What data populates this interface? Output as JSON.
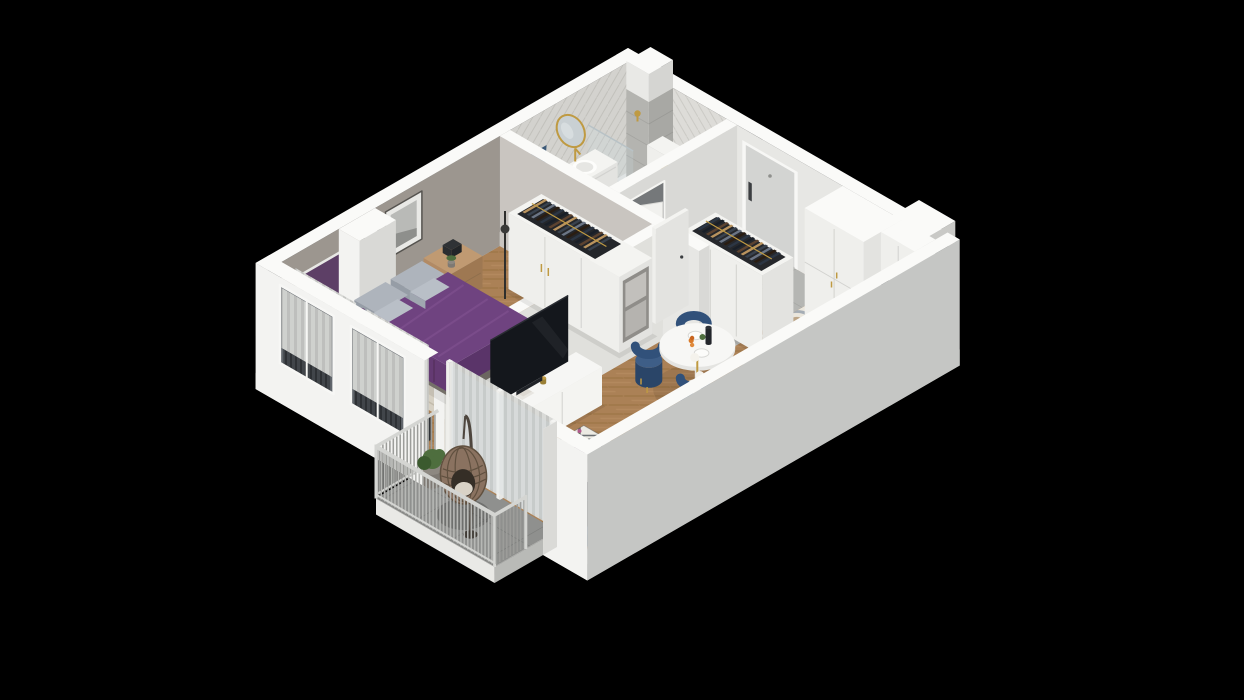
{
  "scene": {
    "name": "isometric-3d-apartment-floor-plan-render",
    "background": "#000000",
    "projection": "isometric-cutaway",
    "rooms": [
      {
        "name": "bathroom",
        "floor": "light-grey-ceramic-tile",
        "walls": "grey-herringbone-tile"
      },
      {
        "name": "hallway",
        "floor": "grey-stone-tile",
        "walls": "white"
      },
      {
        "name": "kitchen",
        "floor": "blue-tan-encaustic-tile",
        "walls": "white"
      },
      {
        "name": "living-dining-room",
        "floor": "herringbone-oak",
        "walls": "white"
      },
      {
        "name": "bedroom",
        "floor": "herringbone-oak",
        "walls": "warm-grey"
      },
      {
        "name": "balcony",
        "floor": "grey-outdoor-tile",
        "walls": "railing"
      }
    ],
    "items": {
      "slab": "building-slab",
      "floors": "room-floors",
      "neWall": "north-east-wall",
      "nwWall": "north-west-wall",
      "swWall": "south-west-wall-with-windows",
      "seWall": "south-east-wall",
      "pier": "wall-pier",
      "vent": "ventilation-shaft",
      "entryDoor": "entry-door",
      "bathDoor": "bathroom-door",
      "bedDoor": "bedroom-door",
      "bathroom": "bathroom-fixtures",
      "vanity": "bathroom-vanity-sink",
      "mirror": "oval-gold-mirror",
      "towel": "blue-towel",
      "toilet": "wall-hung-toilet",
      "washer": "washing-machine",
      "shower": "shower-area",
      "hallWardrobe": "hallway-open-wardrobe",
      "tallCabinets": "kitchen-tall-cabinets",
      "coffeeMachine": "coffee-machine",
      "upperCabinets": "kitchen-upper-cabinets",
      "neCounter": "kitchen-counter-coffee-station",
      "seCounter": "kitchen-counter-sink-cooktop",
      "diningSet": "dining-table-and-chairs",
      "livingLamp": "floor-lamp-globes",
      "sideboard": "tv-sideboard",
      "tv": "television",
      "coffeeTable": "round-coffee-table",
      "sofa": "blue-sofa",
      "livRadiator": "living-room-radiator",
      "livCurtains": "living-room-curtains",
      "glassDoors": "balcony-glass-doors",
      "bedWardrobe": "bedroom-wardrobe",
      "bedLamp": "bedroom-floor-lamp",
      "nightstand": "bedside-table",
      "bed": "double-bed-purple",
      "desk": "bedroom-desk",
      "deskChair": "desk-chair",
      "pinboard": "purple-pinboard",
      "wallArt": "framed-wall-art",
      "bedCurtains": "bedroom-curtains",
      "bedRadiators": "bedroom-radiators",
      "railing": "balcony-railing",
      "plant": "balcony-plant",
      "eggChair": "hanging-egg-chair"
    },
    "clothes_palette": [
      "#2c3644",
      "#191f28",
      "#5d4330",
      "#b9935e",
      "#39424e",
      "#6b7585",
      "#2a1d12"
    ],
    "colors": {
      "wallTop": "#fafaf8",
      "wallInLight": "#e7e7e4",
      "wallInShade": "#d9d9d6",
      "wallBedroom": "#9c968f",
      "wallPartBed": "#c9c5c0",
      "wallPartLiving": "#e0e0dc",
      "extSW": "#f3f3f1",
      "extSE": "#c5c6c4",
      "slabLight": "#e9e9e6",
      "slabShade": "#b9bab7",
      "baseFloor": "#cfcfcc",
      "wood1": "#ab8156",
      "wood2": "#96703f",
      "wood3": "#bc9166",
      "bathTile": "#e4e4e1",
      "bathTileLine": "#d2d2cf",
      "showerMat": "#a9aaa6",
      "hallTile": "#b5b6b3",
      "hallTileLine": "#a3a4a1",
      "balcTile": "#8f908e",
      "balcTileLine": "#7b7c7a",
      "kitBase": "#eae6dc",
      "kitBlue": "#6a7b93",
      "kitTan": "#b59a78",
      "kitLine": "#c9c2b2",
      "wallTileA": "#dddcd8",
      "wallTileALine": "#cbcac5",
      "wallTileB": "#d3d2ce",
      "wallTileBLine": "#c1c0bb",
      "rugBed": "#d6d0c3",
      "rugBedLine": "#c2bbab",
      "rugLivBg": "#eceae3",
      "rugLivFg": "#4b5056",
      "bedTop": "#6f4380",
      "bedSideX": "#5a3469",
      "bedSideY": "#643a73",
      "bedFold": "#7f508f",
      "mattress": "#efeeeb",
      "bedBase": "#7a756f",
      "pillowTop": "#aeb4bc",
      "pillowSide": "#969da6",
      "woodFurn": "#b28a64",
      "woodFurnDark": "#9e7852",
      "white": "#f4f4f1",
      "whiteX": "#e3e3e0",
      "whiteY": "#efefec",
      "seam": "#d2d2cf",
      "gold": "#bf9a42",
      "purpleDeco": "#5d3f66",
      "tv": "#14171c",
      "tvEdge": "#2a2d33",
      "sofaBase": "#2b4765",
      "sofaTop": "#3f6089",
      "sofaFace": "#34547c",
      "sofaArm": "#3a5a82",
      "cushion": "#93a7c0",
      "throw": "#23272e",
      "chairBlue": "#31517a",
      "chairBlueTop": "#3e5e87",
      "chairBlueDark": "#2a4568",
      "counterWood": "#b98e62",
      "counterWoodX": "#a67c50",
      "cooktop": "#17191d",
      "sinkIn": "#dfdfdc",
      "machine": "#2c2e33",
      "curtain": "#d9dad7",
      "curtainShade": "#c6c7c4",
      "radiator": "#41454a",
      "radiatorDark": "#2e3135",
      "railFrame": "#d4d5d2",
      "railSlat": "#b7b8b5",
      "railSlatShade": "#9c9d9a",
      "doorEntry": "#d3d4d2",
      "doorHandle": "#3b3e41",
      "doorWhite": "#f1f1ee",
      "glass": "#cfe0ea",
      "plant": "#4e6e3e",
      "plantDark": "#3b5a2e",
      "pot": "#8d8881",
      "egg": "#8a7260",
      "eggDark": "#60503f",
      "eggCushion": "#d9d2c6",
      "washerDoor": "#2b2e34",
      "toiletWhite": "#f6f6f3",
      "art1": "#b9bab7",
      "art2": "#8e8f8c"
    }
  }
}
